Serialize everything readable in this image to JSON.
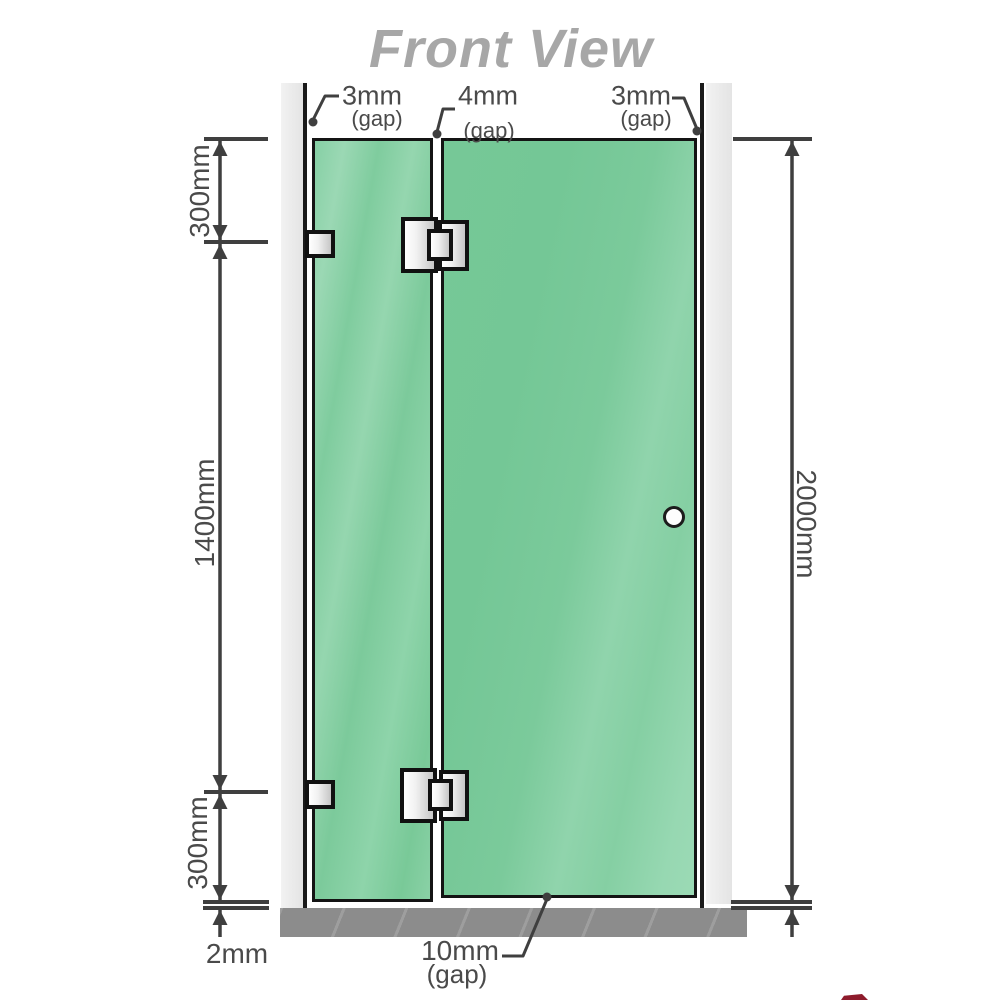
{
  "title": "Front View",
  "dimensions": {
    "top_left_gap": {
      "value": "3mm",
      "label": "(gap)"
    },
    "top_middle_gap": {
      "value": "4mm",
      "label": "(gap)"
    },
    "top_right_gap": {
      "value": "3mm",
      "label": "(gap)"
    },
    "left_top": "300mm",
    "left_middle": "1400mm",
    "left_bottom": "300mm",
    "bottom_floor_gap": "2mm",
    "right_total": "2000mm",
    "bottom_gap": {
      "value": "10mm",
      "label": "(gap)"
    }
  },
  "colors": {
    "glass": "#74c796",
    "glass_highlight": "#90d5ac",
    "wall_channel": "#e7e7e7",
    "floor": "#8c8c8c",
    "dimension_line": "#3f3f3f",
    "panel_outline": "#141414",
    "title_text": "#a7a7a7",
    "label_text": "#4a4a4a"
  }
}
